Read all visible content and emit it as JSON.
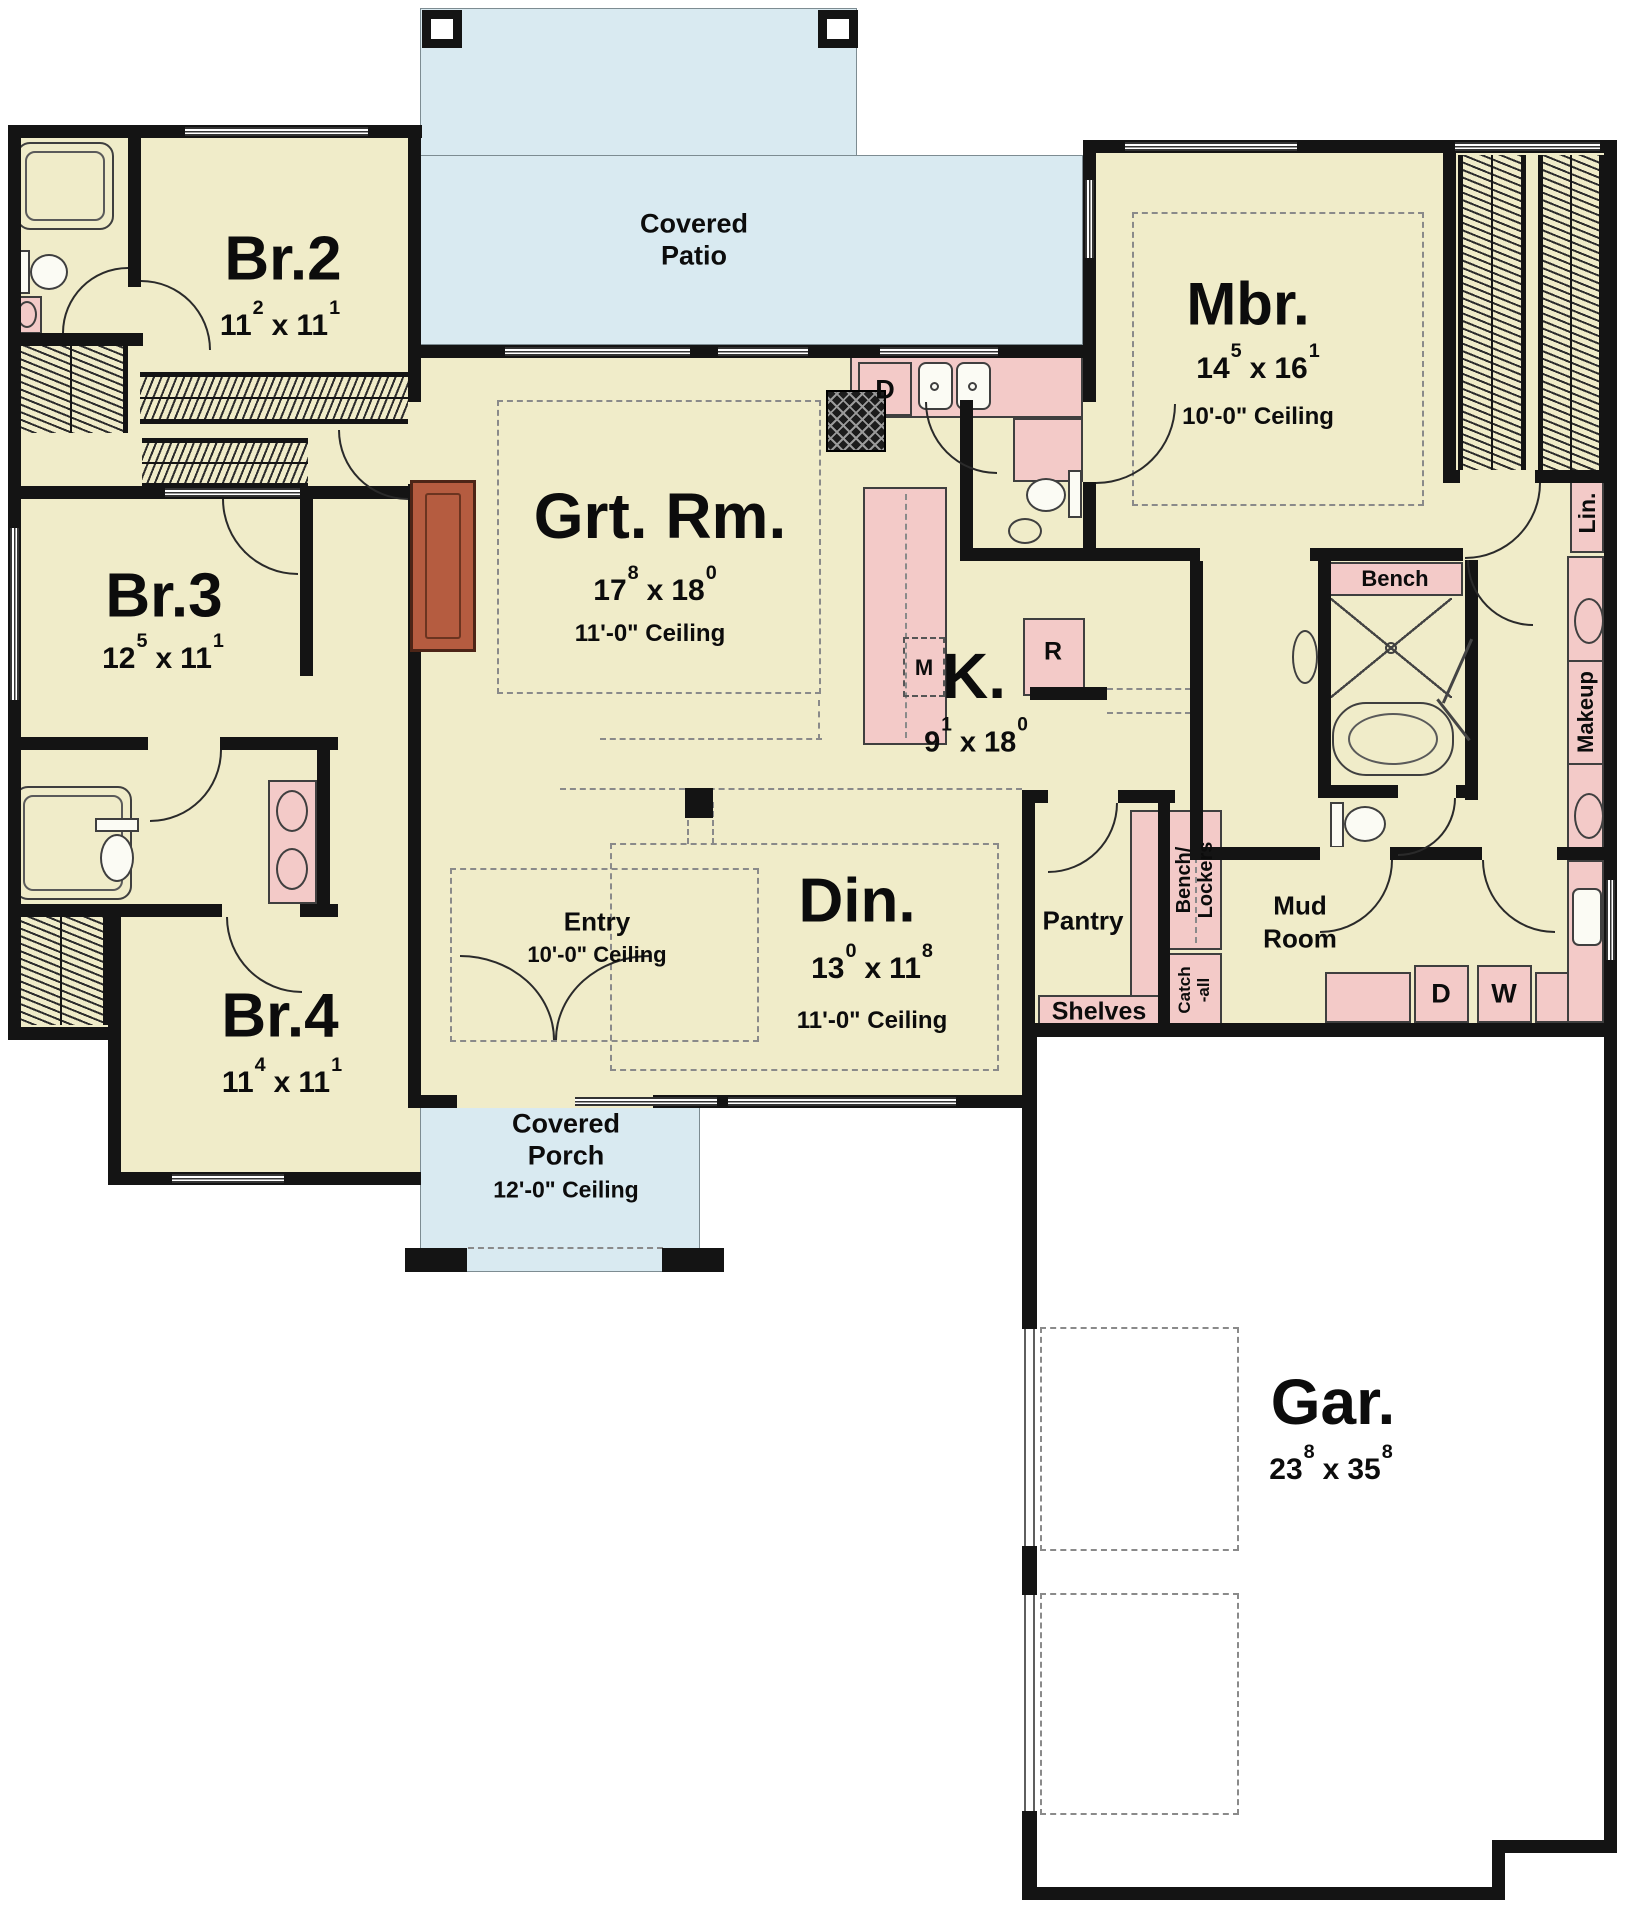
{
  "colors": {
    "room_fill": "#f0ecc9",
    "patio_fill": "#d9eaf1",
    "counter_fill": "#f3cac8",
    "wall": "#141414",
    "fireplace": "#b55c40"
  },
  "ui": {
    "x_sep": "x"
  },
  "rooms": {
    "patio": {
      "name": "Covered Patio"
    },
    "porch": {
      "name": "Covered Porch",
      "ceiling": "12'-0\" Ceiling"
    },
    "entry": {
      "name": "Entry",
      "ceiling": "10'-0\" Ceiling"
    },
    "br2": {
      "name": "Br.2",
      "dim": {
        "w": "11",
        "ws": "2",
        "l": "11",
        "ls": "1"
      }
    },
    "br3": {
      "name": "Br.3",
      "dim": {
        "w": "12",
        "ws": "5",
        "l": "11",
        "ls": "1"
      }
    },
    "br4": {
      "name": "Br.4",
      "dim": {
        "w": "11",
        "ws": "4",
        "l": "11",
        "ls": "1"
      }
    },
    "grt": {
      "name": "Grt. Rm.",
      "dim": {
        "w": "17",
        "ws": "8",
        "l": "18",
        "ls": "0"
      },
      "ceiling": "11'-0\" Ceiling"
    },
    "kitchen": {
      "name": "K.",
      "dim": {
        "w": "9",
        "ws": "1",
        "l": "18",
        "ls": "0"
      }
    },
    "din": {
      "name": "Din.",
      "dim": {
        "w": "13",
        "ws": "0",
        "l": "11",
        "ls": "8"
      },
      "ceiling": "11'-0\" Ceiling"
    },
    "mbr": {
      "name": "Mbr.",
      "dim": {
        "w": "14",
        "ws": "5",
        "l": "16",
        "ls": "1"
      },
      "ceiling": "10'-0\" Ceiling"
    },
    "gar": {
      "name": "Gar.",
      "dim": {
        "w": "23",
        "ws": "8",
        "l": "35",
        "ls": "8"
      }
    },
    "pantry": {
      "name": "Pantry"
    },
    "mud": {
      "name_line1": "Mud",
      "name_line2": "Room"
    }
  },
  "labels": {
    "bench": "Bench",
    "lin": "Lin.",
    "makeup": "Makeup",
    "shelves": "Shelves",
    "bench_lockers_1": "Bench/",
    "bench_lockers_2": "Lockers",
    "catch_all_1": "Catch",
    "catch_all_2": "-all"
  },
  "appliances": {
    "dishwasher": "D",
    "microwave": "M",
    "refrigerator": "R",
    "dryer": "D",
    "washer": "W"
  }
}
